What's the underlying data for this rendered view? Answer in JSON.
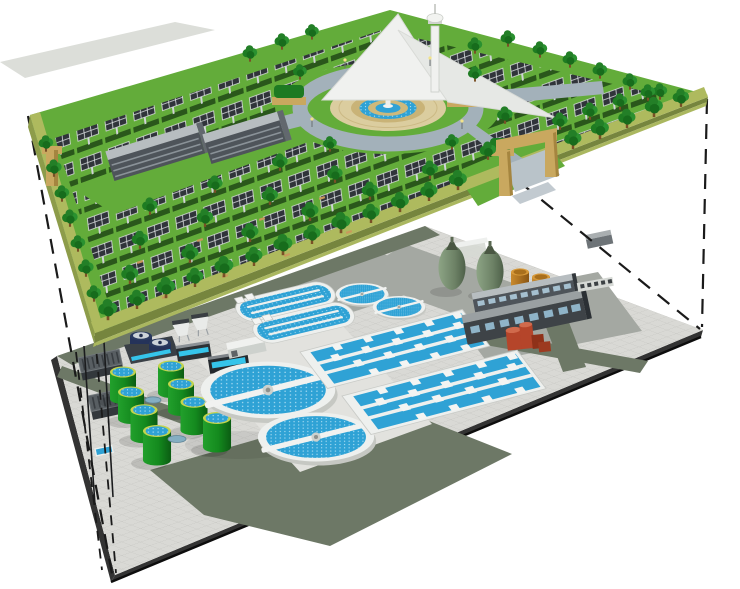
{
  "meta": {
    "title": "3D concept rendering: underground wastewater treatment plant beneath a ground-level solar park",
    "description": "Two stacked isometric platforms joined by dashed projection lines. Top platform: park with rows of solar panels, trees, circular fountain plaza, ring road, observation tower, two office buildings and tan entrance gates. Bottom platform: buried treatment works with circular clarifiers, oxidation ditches, aeration basins, green sludge tanks, egg-shaped digesters, storage tanks and service buildings."
  },
  "colors": {
    "background": "#ffffff",
    "grass": "#63ac3a",
    "platform_edge": "#aeba5e",
    "platform_side": "#8d9c4a",
    "solar_panel": "#30343a",
    "panel_grid": "#e6e9ea",
    "tree_green": "#237f27",
    "water": "#2fa2d5",
    "water_light": "#cdeefb",
    "road_upper": "#a3b1ba",
    "plaza_tan": "#dbcd9f",
    "fountain_tan": "#c9b377",
    "pavement": "#d9d9d5",
    "pavement_line": "#c7c7c3",
    "road_lower": "#6d7866",
    "pad_gray": "#a4a8a2",
    "platform_dark_edge": "#333333",
    "clarifier_rim": "#eef0ee",
    "tank_green_light": "#22a02c",
    "tank_green_dark": "#0b5c13",
    "tank_rim": "#c3d44d",
    "digester_light": "#8da485",
    "digester_dark": "#4e6049",
    "storage_tank_light": "#c98a2e",
    "storage_tank_dark": "#8a5512",
    "building_gray": "#4e545a",
    "building_roof": "#b7bdc0",
    "gate_tan": "#c9a85f",
    "red_unit": "#b5452a",
    "navy_tank": "#2a3a5f",
    "control_screen_blue": "#35c4ea",
    "projection_line": "#1a1a1a",
    "tower_white": "#f0f1ef"
  },
  "upper_level": {
    "label": "Ground-level solar park",
    "features": [
      "rows of elevated solar panels",
      "tree-lined panel rows",
      "central circular plaza with tiered fountain",
      "ring road with radial paths",
      "observation tower with white canopy roofs",
      "two office buildings",
      "tan entrance gate arch",
      "olive landscaped platform edge"
    ]
  },
  "lower_level": {
    "label": "Underground wastewater treatment plant",
    "units": [
      {
        "name": "large circular clarifiers",
        "count": 2
      },
      {
        "name": "small circular clarifiers",
        "count": 2
      },
      {
        "name": "oxidation ditches",
        "count": 2
      },
      {
        "name": "aeration basin blocks",
        "count": 2
      },
      {
        "name": "green sludge holding tanks",
        "count": 8
      },
      {
        "name": "egg-shaped digesters",
        "count": 2
      },
      {
        "name": "storage tanks",
        "count": 2
      },
      {
        "name": "service buildings",
        "count": 4
      },
      {
        "name": "inlet screen works",
        "count": 2
      },
      {
        "name": "red pump unit",
        "count": 1
      }
    ]
  },
  "annotations": {
    "projection_lines": "dashed black lines linking the corners of the two levels"
  }
}
